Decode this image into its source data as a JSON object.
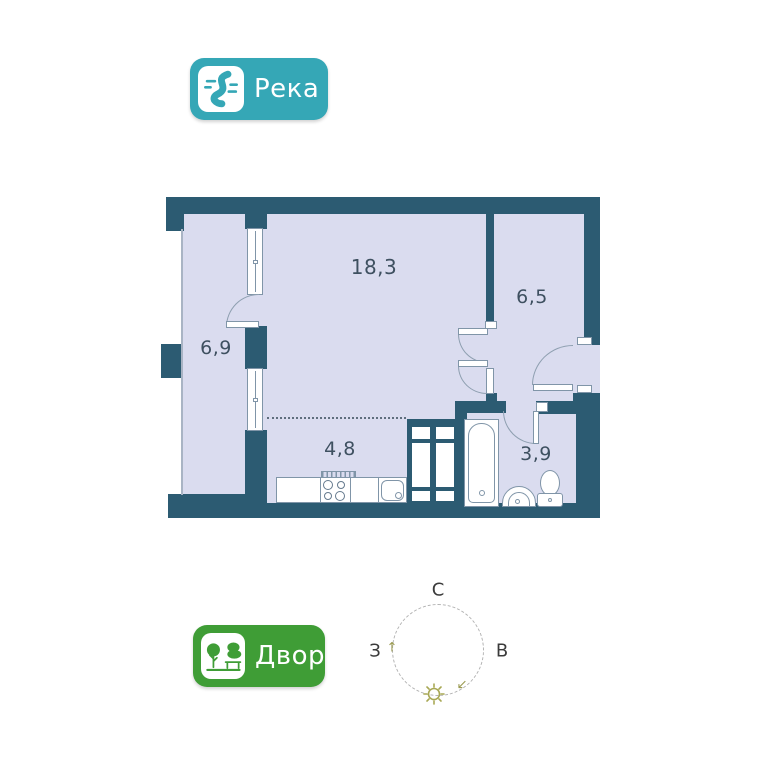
{
  "badges": {
    "river": {
      "label": "Река",
      "color": "#35a7b6",
      "icon": "river-icon"
    },
    "yard": {
      "label": "Двор",
      "color": "#3f9d36",
      "icon": "trees-bench-icon"
    }
  },
  "floor_plan": {
    "wall_color": "#2c5b72",
    "floor_color": "#dadcef",
    "rooms": {
      "living": {
        "area": "18,3"
      },
      "balcony": {
        "area": "6,9"
      },
      "hallway": {
        "area": "6,5"
      },
      "kitchen": {
        "area": "4,8"
      },
      "bathroom": {
        "area": "3,9"
      }
    }
  },
  "compass": {
    "north": "С",
    "east": "В",
    "west": "З",
    "sun": "sun-icon"
  }
}
